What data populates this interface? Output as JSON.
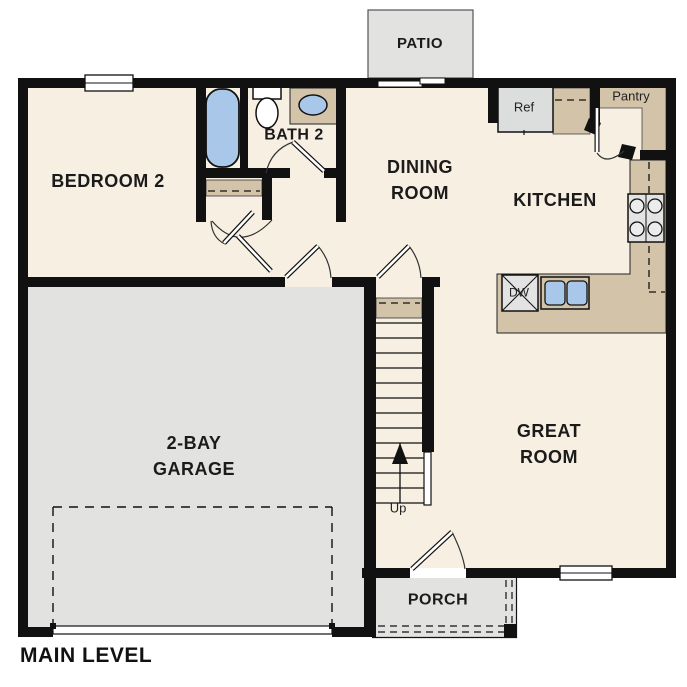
{
  "title": "MAIN LEVEL",
  "rooms": {
    "patio": "PATIO",
    "bedroom2": "BEDROOM 2",
    "bath2": "BATH 2",
    "dining_line1": "DINING",
    "dining_line2": "ROOM",
    "kitchen": "KITCHEN",
    "great_line1": "GREAT",
    "great_line2": "ROOM",
    "garage_line1": "2-BAY",
    "garage_line2": "GARAGE",
    "porch": "PORCH"
  },
  "fixtures": {
    "refrigerator": "Ref",
    "pantry": "Pantry",
    "dishwasher": "DW",
    "stairs_direction": "Up"
  },
  "colors": {
    "floor": "#f7efe2",
    "counter_tan": "#d2c3a9",
    "concrete_gray": "#e2e2e0",
    "fixture_blue": "#a9c8e9",
    "fixture_gray": "#e3e3e3",
    "wall_black": "#111111",
    "outline": "#222222"
  }
}
